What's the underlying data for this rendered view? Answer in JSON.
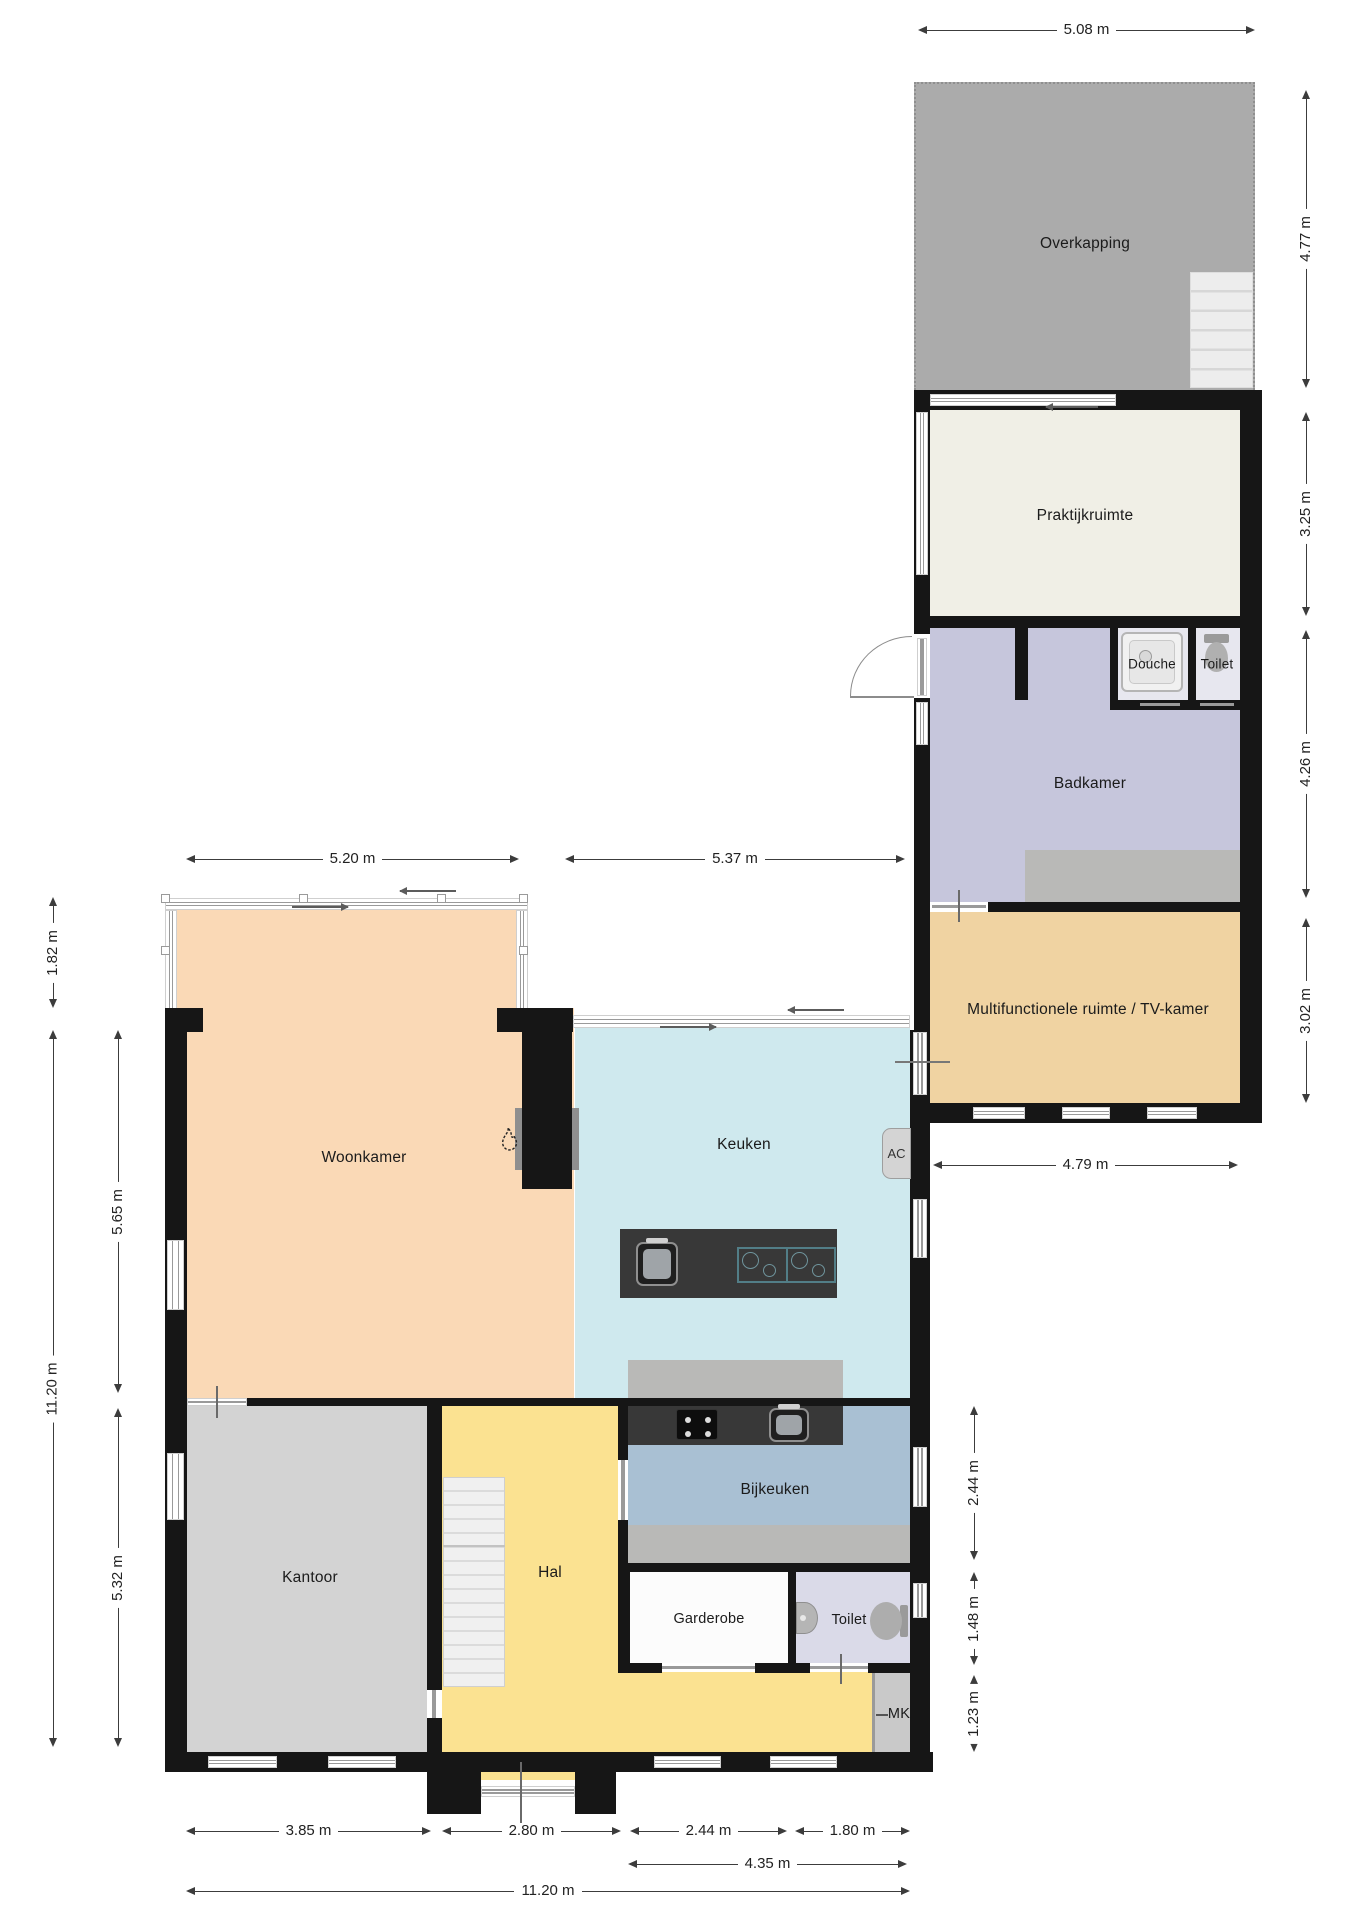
{
  "colors": {
    "wall": "#161616",
    "overkapping": "#ababab",
    "praktijkruimte": "#f0efe6",
    "badkamer": "#c6c6dc",
    "douche_toilet_floor": "#e7e7ef",
    "multifunctionele": "#f0d3a2",
    "woonkamer": "#fad9b6",
    "keuken": "#cfe9ee",
    "bijkeuken": "#a9c0d3",
    "kantoor": "#d3d3d3",
    "hal": "#fbe291",
    "garderobe": "#fcfcfc",
    "toilet": "#dadae8",
    "mk": "#c9c9c9",
    "counter_gray": "#b9b9b7",
    "counter_dark": "#383838",
    "ac_unit": "#d4d4d4"
  },
  "rooms": {
    "overkapping": {
      "label": "Overkapping"
    },
    "praktijkruimte": {
      "label": "Praktijkruimte"
    },
    "douche": {
      "label": "Douche"
    },
    "toilet_boven": {
      "label": "Toilet"
    },
    "badkamer": {
      "label": "Badkamer"
    },
    "multifunctionele": {
      "label": "Multifunctionele ruimte / TV-kamer"
    },
    "woonkamer": {
      "label": "Woonkamer"
    },
    "keuken": {
      "label": "Keuken"
    },
    "bijkeuken": {
      "label": "Bijkeuken"
    },
    "kantoor": {
      "label": "Kantoor"
    },
    "hal": {
      "label": "Hal"
    },
    "garderobe": {
      "label": "Garderobe"
    },
    "toilet_begane_grond": {
      "label": "Toilet"
    },
    "mk": {
      "label": "MK"
    },
    "ac": {
      "label": "AC"
    }
  },
  "dimensions": {
    "overkapping_width": "5.08 m",
    "overkapping_depth": "4.77 m",
    "praktijkruimte_depth": "3.25 m",
    "badkamer_depth": "4.26 m",
    "multifunctionele_depth": "3.02 m",
    "woonkamer_width": "5.20 m",
    "keuken_width": "5.37 m",
    "wing_width": "4.79 m",
    "serre_depth": "1.82 m",
    "house_depth": "11.20 m",
    "woonkamer_depth": "5.65 m",
    "kantoor_depth": "5.32 m",
    "bijkeuken_depth": "2.44 m",
    "toilet_depth": "1.48 m",
    "mk_depth": "1.23 m",
    "kantoor_width": "3.85 m",
    "hal_width": "2.80 m",
    "garderobe_width": "2.44 m",
    "toilet_width": "1.80 m",
    "right_section_width": "4.35 m",
    "house_width": "11.20 m"
  }
}
